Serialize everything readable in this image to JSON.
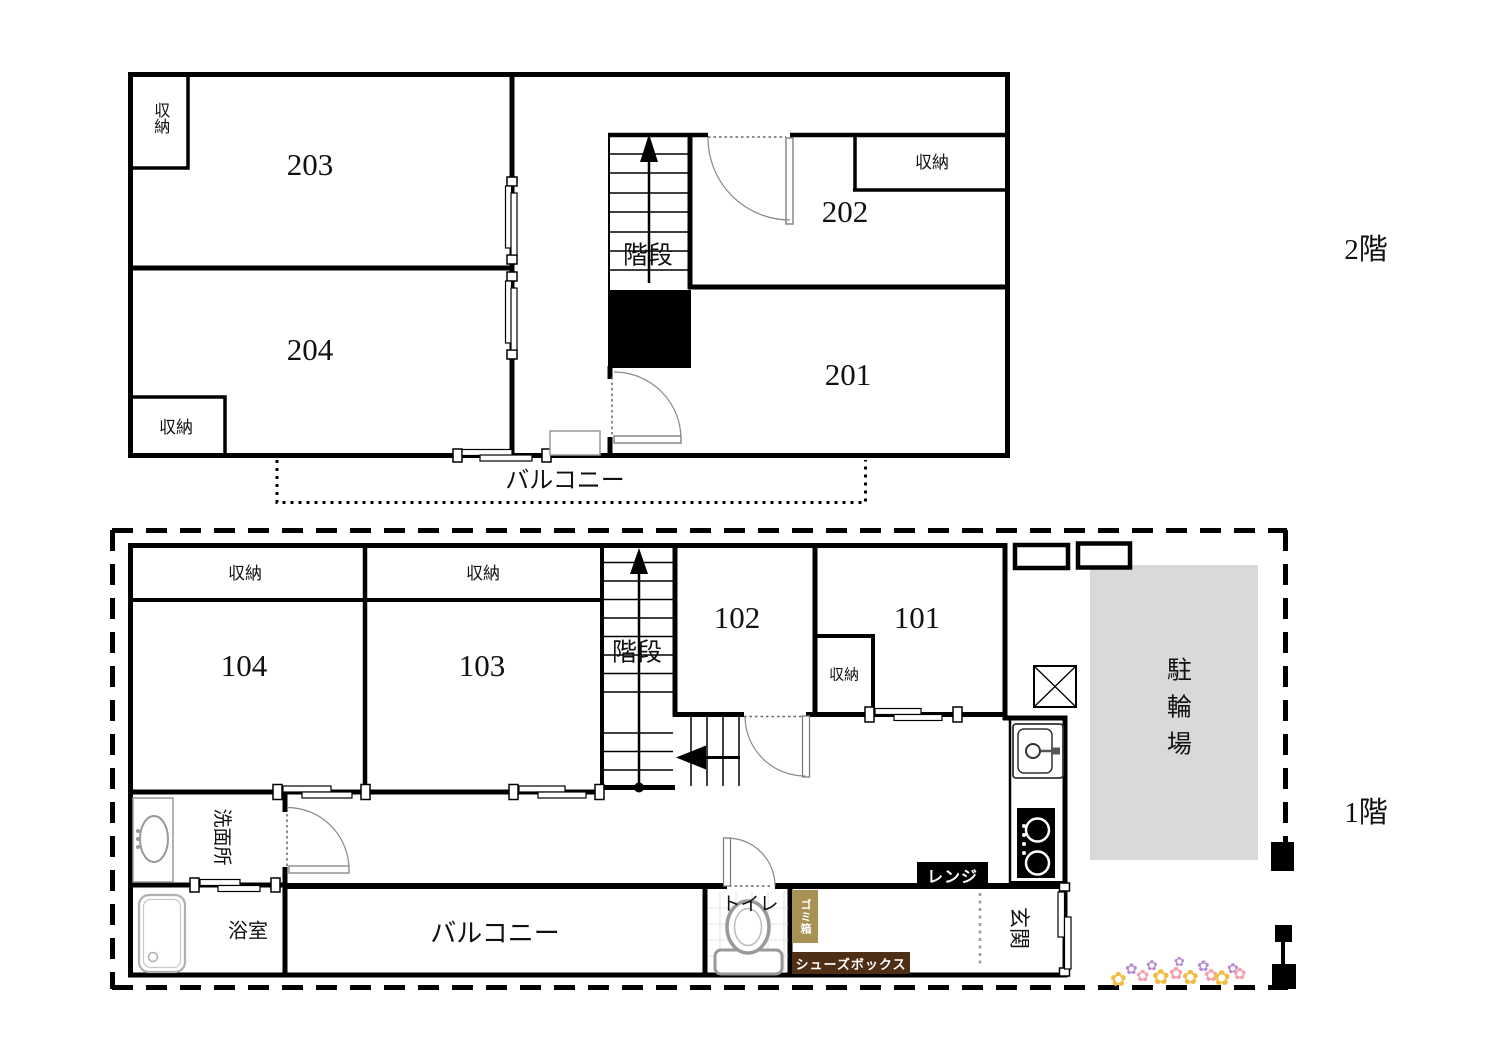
{
  "floors": {
    "second": {
      "floor_label": "2階",
      "room_203": "203",
      "room_204": "204",
      "room_202": "202",
      "room_201": "201",
      "storage_203": "収納",
      "storage_204": "収納",
      "storage_202": "収納",
      "stairs_label": "階段",
      "balcony_label": "バルコニー"
    },
    "first": {
      "floor_label": "1階",
      "room_104": "104",
      "room_103": "103",
      "room_102": "102",
      "room_101": "101",
      "storage_104": "収納",
      "storage_103": "収納",
      "storage_101": "収納",
      "stairs_label": "階段",
      "washroom_label": "洗面所",
      "bathroom_label": "浴室",
      "balcony_label": "バルコニー",
      "toilet_label": "トイレ",
      "trash_box_label": "ゴミ箱",
      "shoe_box_label": "シューズボックス",
      "range_label": "レンジ",
      "entrance_label": "玄関",
      "bicycle_parking_label": "駐輪場"
    }
  },
  "colors": {
    "wall": "#000000",
    "bicycle_area_fill": "#d9d9d9",
    "trash_box_bg": "#a89154",
    "shoe_box_bg": "#4e2e14",
    "range_bg": "#000000",
    "label_text": "#111111",
    "flower_yellow": "#f2bc42",
    "flower_purple": "#b58cd0",
    "flower_pink": "#f49fb0"
  }
}
